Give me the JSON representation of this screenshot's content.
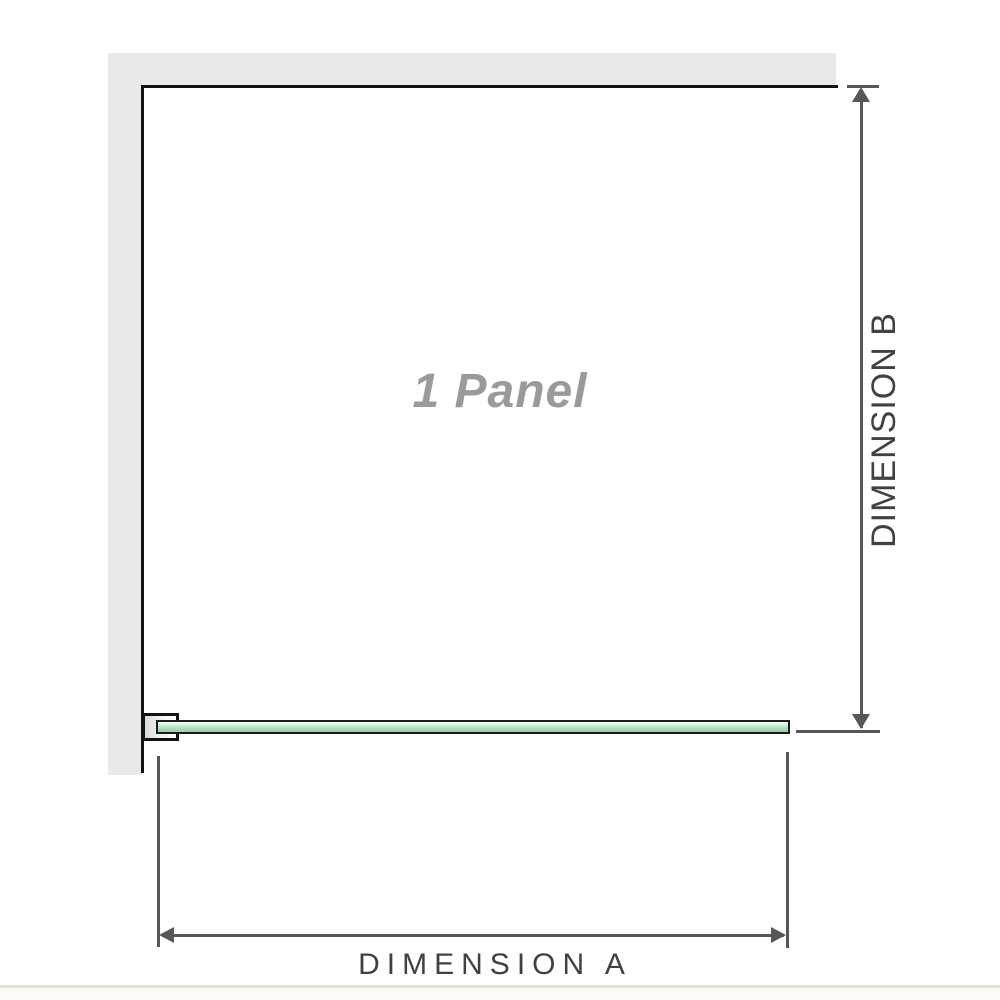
{
  "diagram": {
    "panel_label": "1 Panel",
    "dimension_a": {
      "label": "DIMENSION A"
    },
    "dimension_b": {
      "label": "DIMENSION B"
    }
  },
  "colors": {
    "background": "#ffffff",
    "wall-fill": "#e9e9e9",
    "frame-line": "#121212",
    "dim-line": "#575757",
    "dim-text": "#3f4245",
    "panel-label-text": "#9a9a9a",
    "glass-border": "#1c1c1c",
    "glass-light": "#f1faf3",
    "glass-mid": "#aedec0",
    "glass-deep": "#96cfa9",
    "footer-line": "#e4e1d8",
    "footer-strip": "#fbfaf6"
  }
}
